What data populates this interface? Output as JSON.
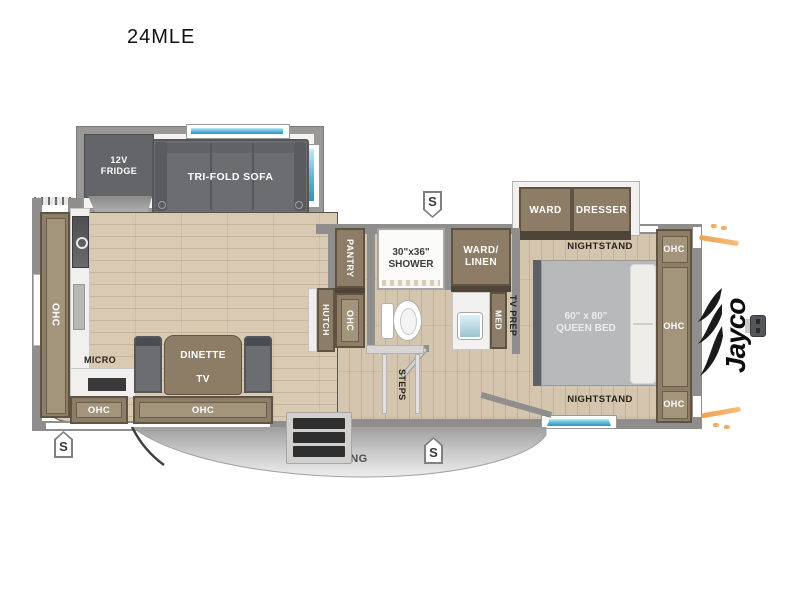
{
  "title": "24MLE",
  "brand": {
    "name": "Jayco"
  },
  "labels": {
    "fridge": "12V\nFRIDGE",
    "sofa": "TRI-FOLD SOFA",
    "ohc": "OHC",
    "micro": "MICRO",
    "dinette": "DINETTE",
    "tv": "TV",
    "hutch": "HUTCH",
    "pantry": "PANTRY",
    "shower": "30\"x36\"\nSHOWER",
    "ward_linen": "WARD/\nLINEN",
    "med": "MED",
    "tv_prep": "TV PREP",
    "steps": "STEPS",
    "ward": "WARD",
    "dresser": "DRESSER",
    "nightstand": "NIGHTSTAND",
    "queen_bed": "60\" x 80\"\nQUEEN BED",
    "awning": "16' AWNING",
    "speaker": "S"
  },
  "colors": {
    "wall": "#908e8c",
    "floor": "#d9cab3",
    "cabinet": "#8d7d66",
    "cabinet_dark": "#5f5343",
    "furniture_gray": "#6b6d70",
    "window_teal": "#56b8d6",
    "awning_silver": "#c9c9c9",
    "accent_orange": "#eda24e",
    "logo_black": "#0d0d0d"
  }
}
